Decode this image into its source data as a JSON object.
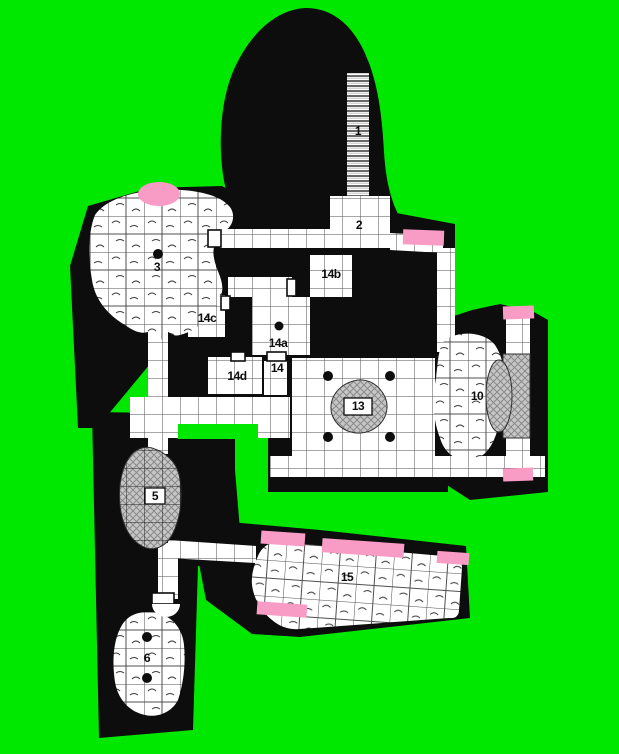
{
  "map": {
    "kind": "dungeon-floor-plan",
    "rooms": null
  },
  "rooms": [
    {
      "label": "1",
      "kind": "staircase"
    },
    {
      "label": "2",
      "kind": "room"
    },
    {
      "label": "3",
      "kind": "cavern"
    },
    {
      "label": "5",
      "kind": "rubble-cavern"
    },
    {
      "label": "6",
      "kind": "cavern"
    },
    {
      "label": "10",
      "kind": "cavern"
    },
    {
      "label": "13",
      "kind": "pillared-hall"
    },
    {
      "label": "14",
      "kind": "passage"
    },
    {
      "label": "14a",
      "kind": "room"
    },
    {
      "label": "14b",
      "kind": "room"
    },
    {
      "label": "14c",
      "kind": "room"
    },
    {
      "label": "14d",
      "kind": "room"
    },
    {
      "label": "15",
      "kind": "great-cavern"
    }
  ],
  "features": [
    "staircase",
    "door",
    "door-highlight-marker",
    "pillar-dot",
    "rubble-mound",
    "cave-floor"
  ],
  "colors": {
    "background": "#00e800",
    "wall": "#0d0d0d",
    "floor": "#ffffff",
    "grid_line": "#4f4f4f",
    "door_highlight": "#f89bc5",
    "rubble_fill": "#c6c6c6",
    "rubble_line": "#8a8a8a"
  }
}
